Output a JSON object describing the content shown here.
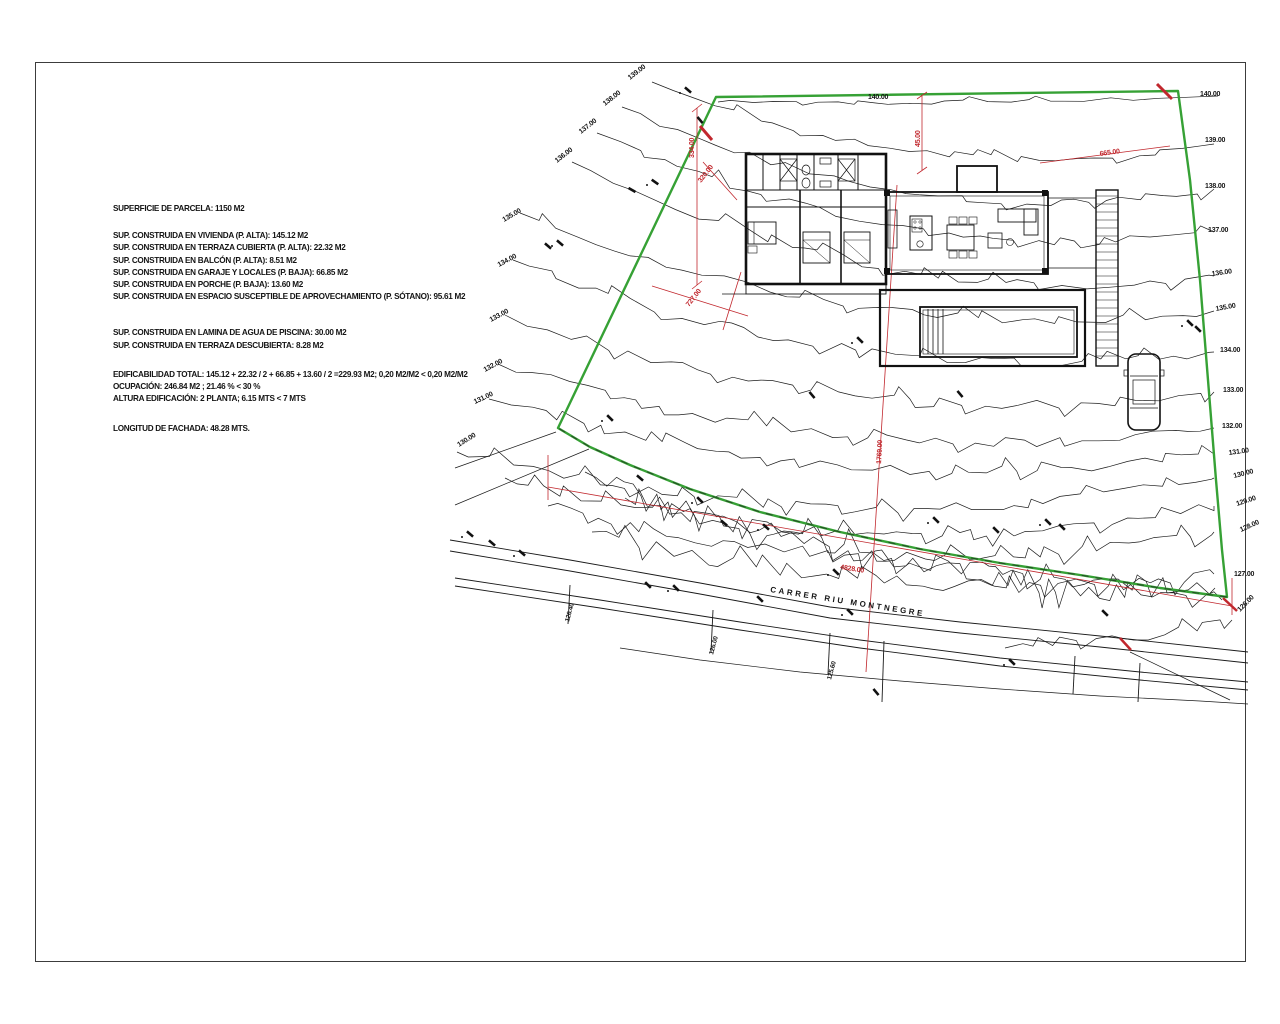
{
  "plan": {
    "notes": {
      "parcel": "SUPERFICIE DE PARCELA: 1150 M2",
      "built": [
        "SUP. CONSTRUIDA EN VIVIENDA (P. ALTA):  145.12 M2",
        "SUP. CONSTRUIDA EN TERRAZA CUBIERTA (P. ALTA):  22.32 M2",
        "SUP. CONSTRUIDA EN BALCÓN  (P. ALTA):  8.51 M2",
        "SUP. CONSTRUIDA EN GARAJE Y LOCALES (P. BAJA):  66.85 M2",
        "SUP. CONSTRUIDA EN PORCHE (P. BAJA):  13.60 M2",
        "SUP. CONSTRUIDA EN ESPACIO SUSCEPTIBLE DE APROVECHAMIENTO (P. SÓTANO):  95.61 M2"
      ],
      "water": [
        "SUP. CONSTRUIDA EN LAMINA DE AGUA DE PISCINA:  30.00 M2",
        "SUP. CONSTRUIDA EN TERRAZA DESCUBIERTA:  8.28 M2"
      ],
      "totals": [
        "EDIFICABILIDAD TOTAL:  145.12 + 22.32 / 2 + 66.85 + 13.60 / 2 =229.93 M2; 0,20 M2/M2 < 0,20 M2/M2",
        "OCUPACIÓN: 246.84 M2 ; 21.46 % < 30 %",
        "ALTURA EDIFICACIÓN:  2 PLANTA; 6.15 MTS < 7 MTS"
      ],
      "facade": "LONGITUD DE FACHADA: 48.28 MTS."
    },
    "road_label": "CARRER RIU MONTNEGRE",
    "colors": {
      "boundary": "#36a135",
      "dimension": "#c1272d",
      "linework": "#1a1a1a"
    },
    "contour_labels_right": [
      {
        "t": "140.00",
        "x": 1200,
        "y": 96,
        "r": 0
      },
      {
        "t": "139.00",
        "x": 1205,
        "y": 142,
        "r": 0
      },
      {
        "t": "138.00",
        "x": 1205,
        "y": 188,
        "r": 0
      },
      {
        "t": "137.00",
        "x": 1208,
        "y": 232,
        "r": 0
      },
      {
        "t": "136.00",
        "x": 1212,
        "y": 276,
        "r": -8
      },
      {
        "t": "135.00",
        "x": 1216,
        "y": 311,
        "r": -10
      },
      {
        "t": "134.00",
        "x": 1220,
        "y": 352,
        "r": 0
      },
      {
        "t": "133.00",
        "x": 1223,
        "y": 392,
        "r": 0
      },
      {
        "t": "132.00",
        "x": 1222,
        "y": 428,
        "r": 0
      },
      {
        "t": "131.00",
        "x": 1229,
        "y": 455,
        "r": -8
      },
      {
        "t": "130.00",
        "x": 1234,
        "y": 478,
        "r": -14
      },
      {
        "t": "129.00",
        "x": 1237,
        "y": 506,
        "r": -18
      },
      {
        "t": "128.00",
        "x": 1241,
        "y": 532,
        "r": -24
      },
      {
        "t": "127.00",
        "x": 1234,
        "y": 576,
        "r": 0
      },
      {
        "t": "126.00",
        "x": 1240,
        "y": 612,
        "r": -45
      }
    ],
    "contour_labels_left": [
      {
        "t": "139.00",
        "x": 630,
        "y": 80,
        "r": -38
      },
      {
        "t": "138.00",
        "x": 605,
        "y": 106,
        "r": -38
      },
      {
        "t": "137.00",
        "x": 581,
        "y": 134,
        "r": -38
      },
      {
        "t": "136.00",
        "x": 557,
        "y": 163,
        "r": -38
      },
      {
        "t": "135.00",
        "x": 504,
        "y": 222,
        "r": -30
      },
      {
        "t": "134.00",
        "x": 499,
        "y": 267,
        "r": -28
      },
      {
        "t": "133.00",
        "x": 491,
        "y": 322,
        "r": -28
      },
      {
        "t": "132.00",
        "x": 485,
        "y": 372,
        "r": -28
      },
      {
        "t": "131.00",
        "x": 475,
        "y": 404,
        "r": -25
      },
      {
        "t": "130.00",
        "x": 459,
        "y": 447,
        "r": -32
      },
      {
        "t": "140.00",
        "x": 868,
        "y": 99,
        "r": 0
      }
    ],
    "dim_labels": [
      {
        "t": "334.00",
        "x": 694,
        "y": 158,
        "r": -90
      },
      {
        "t": "320.00",
        "x": 701,
        "y": 183,
        "r": -52
      },
      {
        "t": "727.00",
        "x": 689,
        "y": 307,
        "r": -52
      },
      {
        "t": "45.00",
        "x": 920,
        "y": 147,
        "r": -90
      },
      {
        "t": "665.00",
        "x": 1100,
        "y": 156,
        "r": -8
      },
      {
        "t": "1769.00",
        "x": 881,
        "y": 464,
        "r": -87
      },
      {
        "t": "4828.00",
        "x": 840,
        "y": 569,
        "r": 9
      }
    ],
    "road_elev_labels": [
      {
        "t": "126.40",
        "x": 569,
        "y": 622,
        "r": -75
      },
      {
        "t": "126.00",
        "x": 713,
        "y": 655,
        "r": -75
      },
      {
        "t": "125.60",
        "x": 831,
        "y": 680,
        "r": -75
      }
    ]
  }
}
